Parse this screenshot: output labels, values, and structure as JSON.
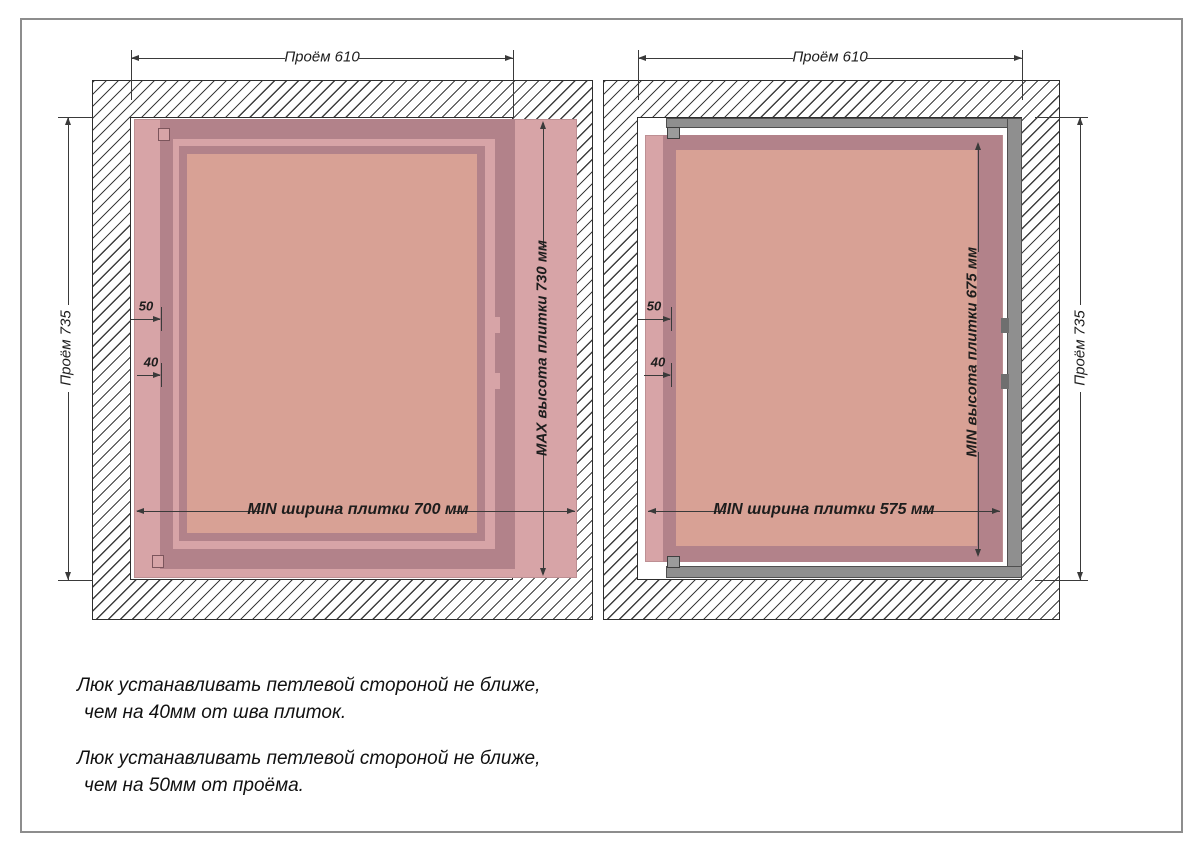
{
  "left_diagram": {
    "title": "max-tile-variant",
    "opening_width": "Проём 610",
    "opening_height": "Проём 735",
    "tile_height": "MAX высота плитки 730 мм",
    "tile_width": "MIN ширина плитки 700 мм",
    "offset_from_opening": "50",
    "offset_from_seam": "40"
  },
  "right_diagram": {
    "title": "min-tile-variant",
    "opening_width": "Проём 610",
    "opening_height": "Проём 735",
    "tile_height": "MIN высота плитки 675 мм",
    "tile_width": "MIN ширина плитки 575 мм",
    "offset_from_opening": "50",
    "offset_from_seam": "40"
  },
  "notes": [
    {
      "line1": "Люк устанавливать петлевой стороной не ближе,",
      "line2": "чем на 40мм от шва плиток."
    },
    {
      "line1": "Люк устанавливать петлевой стороной не ближе,",
      "line2": "чем на 50мм от проёма."
    }
  ],
  "colors": {
    "tile": "#d7a4a7",
    "frame-dark": "#b2828a",
    "panel": "#d8a195",
    "metal": "#8f8f8f",
    "line": "#3a3a3a",
    "text": "#1d1d1d"
  }
}
